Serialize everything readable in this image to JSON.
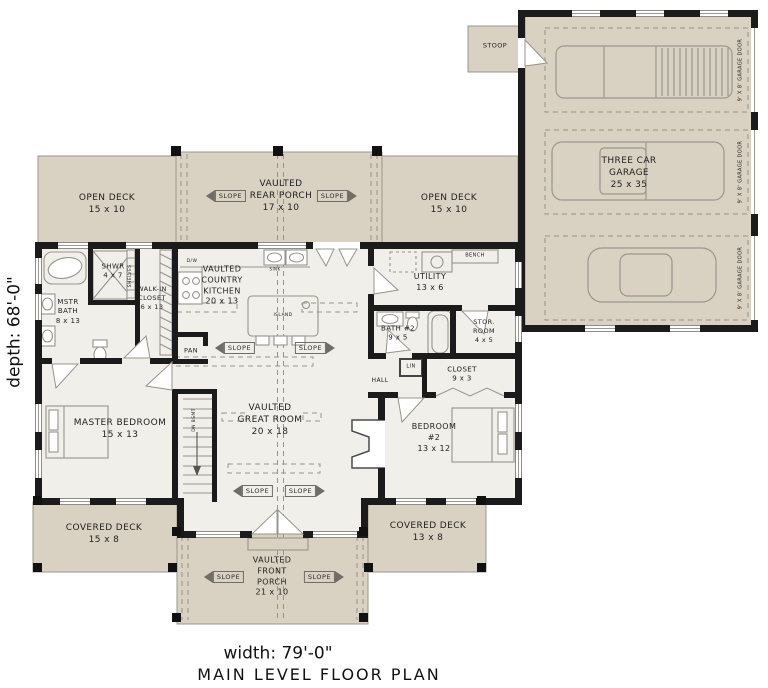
{
  "title": "MAIN LEVEL FLOOR PLAN",
  "dimensions": {
    "width": "width: 79'-0\"",
    "depth": "depth: 68'-0\""
  },
  "labels": {
    "slope": "SLOPE"
  },
  "garage": {
    "stoop": "STOOP",
    "name": "THREE CAR\nGARAGE\n25 x 35",
    "door": "9' X 8' GARAGE DOOR"
  },
  "outdoor": {
    "open_deck_left": "OPEN DECK\n15 x 10",
    "rear_porch": "VAULTED\nREAR PORCH\n17 x 10",
    "open_deck_right": "OPEN DECK\n15 x 10",
    "covered_deck_left": "COVERED DECK\n15 x 8",
    "covered_deck_right": "COVERED DECK\n13 x 8",
    "front_porch": "VAULTED\nFRONT\nPORCH\n21 x 10"
  },
  "rooms": {
    "master_bath": "MSTR\nBATH\n8 x 13",
    "shower": "SHWR\n4 x 7",
    "walk_in_closet": "WALK-IN\nCLOSET\n6 x 13",
    "kitchen": "VAULTED\nCOUNTRY\nKITCHEN\n20 x 13",
    "utility": "UTILITY\n13 x 6",
    "bath2": "BATH #2\n9 x 5",
    "storage": "STOR.\nROOM\n4 x 5",
    "closet": "CLOSET\n9 x 3",
    "hall": "HALL",
    "master_bedroom": "MASTER BEDROOM\n15 x 13",
    "great_room": "VAULTED\nGREAT ROOM\n20 x 18",
    "bedroom2": "BEDROOM\n#2\n13 x 12"
  },
  "fixtures": {
    "pantry": "PAN",
    "island": "ISLAND",
    "dishwasher": "D/W",
    "sink": "SINK",
    "bench": "BENCH",
    "shelves": "SHELVES",
    "linen": "LIN",
    "stairs": "DN BSMT"
  },
  "colors": {
    "deck_fill": "#d9d1c1",
    "interior_fill": "#f0efe9",
    "wall": "#1b1b1b",
    "line": "#97948b"
  }
}
